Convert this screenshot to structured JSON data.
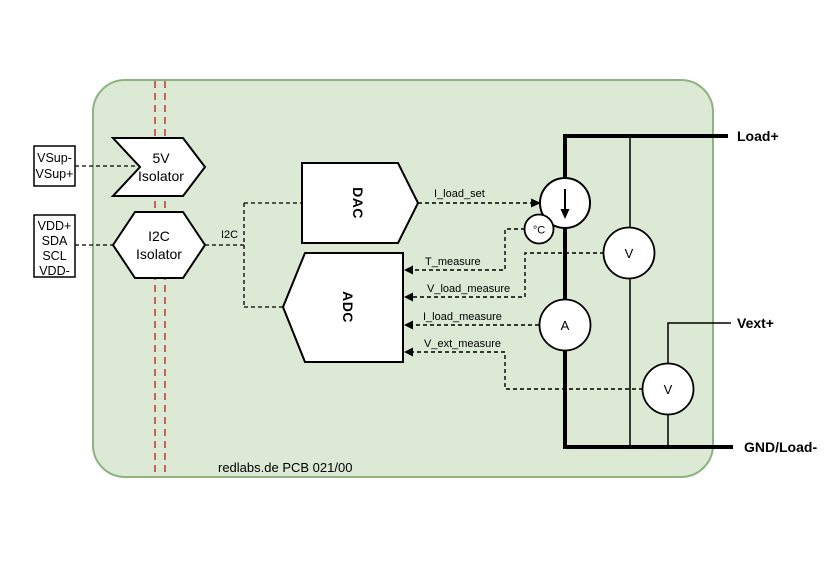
{
  "footer": {
    "text": "redlabs.de PCB 021/00"
  },
  "connectors": {
    "vsup_box": {
      "lines": [
        "VSup-",
        "VSup+"
      ]
    },
    "vdd_box": {
      "lines": [
        "VDD+",
        "SDA",
        "SCL",
        "VDD-"
      ]
    }
  },
  "blocks": {
    "isolator_5v": {
      "title": "5V",
      "subtitle": "Isolator"
    },
    "isolator_i2c": {
      "title": "I2C",
      "subtitle": "Isolator"
    },
    "dac": {
      "label": "DAC"
    },
    "adc": {
      "label": "ADC"
    }
  },
  "nets": {
    "i2c_bus": "I2C",
    "i_load_set": "I_load_set",
    "t_measure": "T_measure",
    "v_load_measure": "V_load_measure",
    "i_load_measure": "I_load_measure",
    "v_ext_measure": "V_ext_measure"
  },
  "meters": {
    "temp_sensor": "°C",
    "load_voltmeter": "V",
    "ammeter": "A",
    "ext_voltmeter": "V"
  },
  "terminals": {
    "load_plus": "Load+",
    "vext_plus": "Vext+",
    "gnd_load_minus": "GND/Load-"
  },
  "icons": {
    "current_source_symbol": "down-arrow-icon"
  },
  "colors": {
    "board_fill": "#dbe9d5",
    "board_border": "#8fb282",
    "isolation_barrier": "#c4423c",
    "line": "#000000"
  }
}
